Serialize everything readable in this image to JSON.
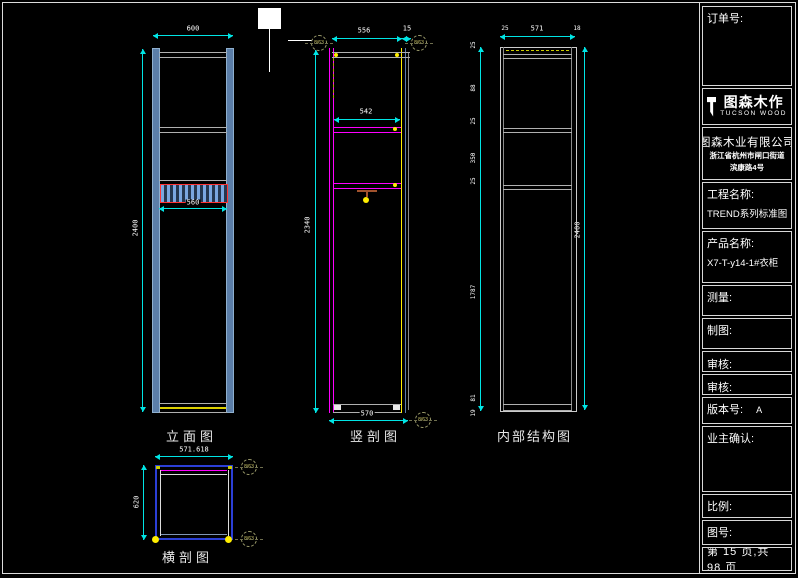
{
  "colors": {
    "background": "#000000",
    "dimension": "#00e5e5",
    "magenta": "#ff00ff",
    "yellow": "#ffee00",
    "panel_blue": "#5b7ea8",
    "red_outline": "#ff3333",
    "plan_blue": "#2b3fd6",
    "line_gray": "#b0b0b0"
  },
  "views": {
    "elevation": {
      "label": "立面图",
      "dims": {
        "width": "600",
        "height": "2400",
        "drawer": "560"
      }
    },
    "vertical_section": {
      "label": "竖剖图",
      "dims": {
        "inner_width": "556",
        "panel": "15",
        "shelf_width": "542",
        "height": "2340",
        "bottom_width": "570"
      },
      "callouts": [
        "8/63",
        "8/63",
        "8/63"
      ]
    },
    "structure": {
      "label": "内部结构图",
      "dims": {
        "left": "25",
        "width": "571",
        "right": "18",
        "height": "2400",
        "chain": [
          "25",
          "88",
          "25",
          "350",
          "25",
          "1787",
          "81",
          "19"
        ]
      }
    },
    "horizontal_section": {
      "label": "横剖图",
      "dims": {
        "width": "571.618",
        "depth": "620"
      },
      "callouts": [
        "8/63",
        "8/63"
      ]
    }
  },
  "title_block": {
    "order_label": "订单号:",
    "logo_name": "图森木作",
    "logo_sub": "TUCSON WOOD",
    "company": "图森木业有限公司",
    "address1": "浙江省杭州市闸口街道",
    "address2": "滨康路4号",
    "project_label": "工程名称:",
    "project_value": "TREND系列标准图",
    "product_label": "产品名称:",
    "product_value": "X7-T-y14-1#衣柜",
    "survey_label": "测量:",
    "draft_label": "制图:",
    "review_label": "审核:",
    "review2_label": "审核:",
    "version_label": "版本号:",
    "version_value": "A",
    "owner_label": "业主确认:",
    "scale_label": "比例:",
    "drawing_no_label": "图号:",
    "page_info": "第 15 页,共 98 页"
  }
}
